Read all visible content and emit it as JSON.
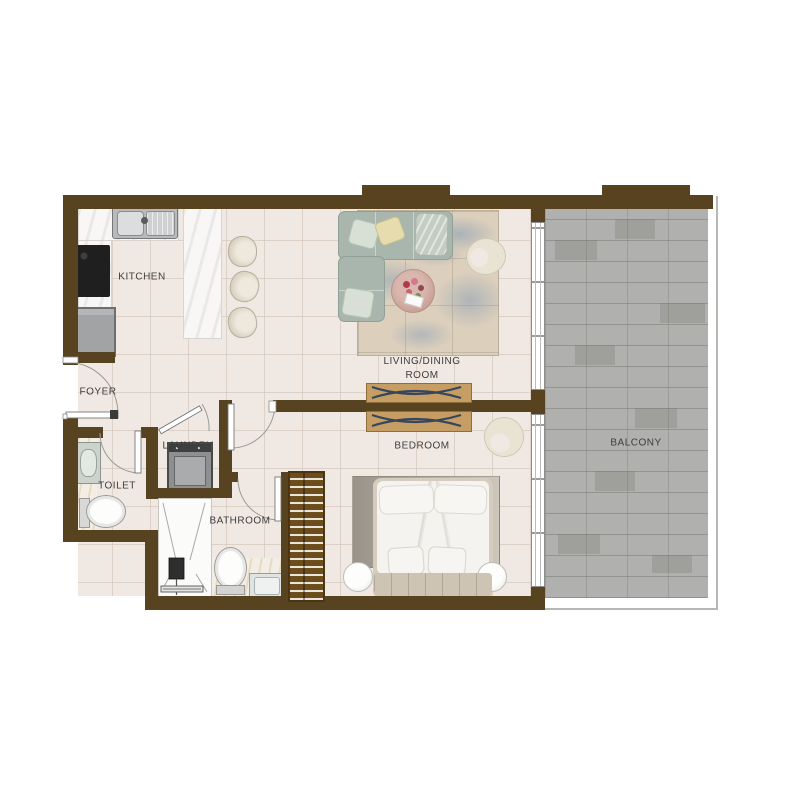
{
  "document": {
    "type": "apartment-floor-plan",
    "background": "#ffffff"
  },
  "rooms": {
    "kitchen": {
      "label": "KITCHEN"
    },
    "foyer": {
      "label": "FOYER"
    },
    "toilet": {
      "label": "TOILET"
    },
    "laundry": {
      "label": "LAUNDRY"
    },
    "bathroom": {
      "label": "BATHROOM"
    },
    "living_dining": {
      "label": "LIVING/DINING ROOM"
    },
    "bedroom": {
      "label": "BEDROOM"
    },
    "balcony": {
      "label": "BALCONY"
    }
  },
  "palette": {
    "wall_brown": "#57431f",
    "floor_tile": "#f0e9e3",
    "balcony_tile": "#b0b0ae",
    "counter_marble": "#f8f7f5",
    "wood_wardrobe": "#6e4d1d",
    "wood_console": "#c69d63",
    "sofa_green_gray": "#a9b6ae",
    "label_text": "#3d3d3d"
  },
  "fixtures": [
    "kitchen-sink",
    "cooktop",
    "refrigerator",
    "kitchen-island",
    "bar-stool",
    "bar-stool",
    "bar-stool",
    "sectional-sofa",
    "coffee-table",
    "living-armchair",
    "tv-console",
    "double-bed",
    "nightstand",
    "nightstand",
    "bedroom-armchair",
    "wardrobe",
    "washing-machine",
    "shower",
    "toilet-wc",
    "bathroom-wc",
    "toilet-basin",
    "bathroom-sink",
    "living-rug",
    "bedroom-rug"
  ]
}
